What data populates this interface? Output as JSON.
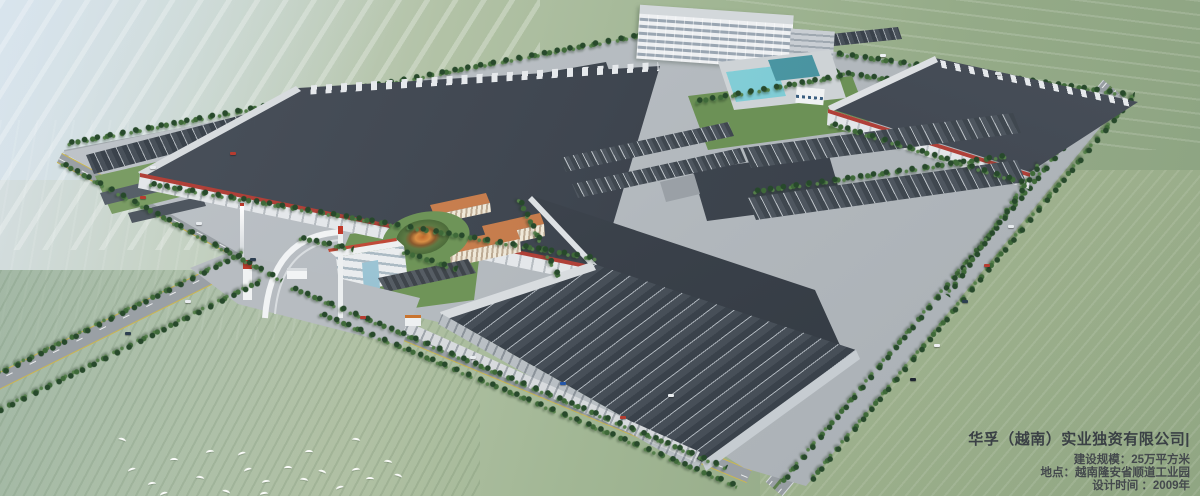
{
  "overlay": {
    "company_title": "华孚（越南）实业独资有限公司|",
    "details": [
      "建设规模：25万平方米",
      "地点：越南隆安省顺道工业园",
      "设计时间 ：2009年"
    ]
  },
  "palette": {
    "accent_red": "#b04038",
    "roof_dark": "#3a414a",
    "wall_white": "#e4e7ea",
    "pool_cyan": "#6fc3cf",
    "tile_orange": "#c8784a",
    "field_green": "#9ab38c",
    "text": "#3e4347"
  }
}
